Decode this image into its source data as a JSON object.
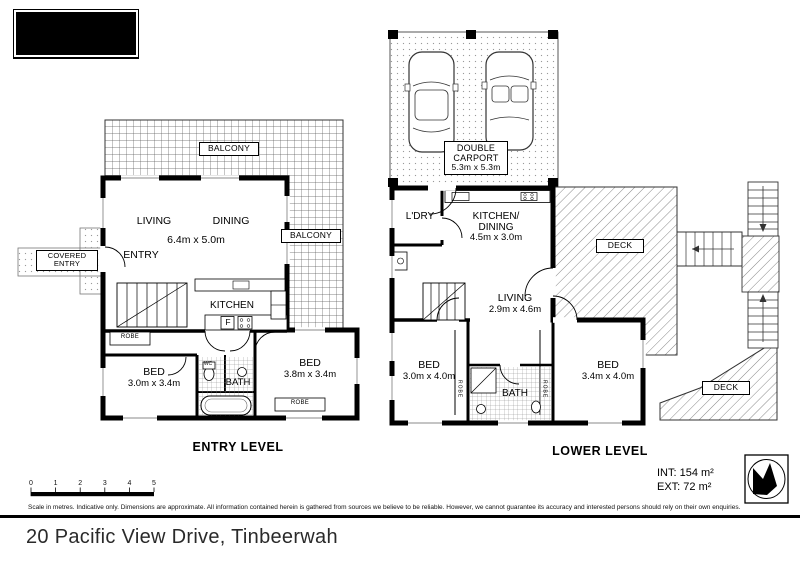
{
  "colors": {
    "ink": "#000000",
    "paper": "#ffffff",
    "hatch": "#6a6a6a"
  },
  "entry_level": {
    "title": "ENTRY LEVEL",
    "labels": {
      "balcony_top": "BALCONY",
      "balcony_right": "BALCONY",
      "living": "LIVING",
      "dining": "DINING",
      "living_dining_dims": "6.4m x 5.0m",
      "entry": "ENTRY",
      "covered_entry": "COVERED ENTRY",
      "kitchen": "KITCHEN",
      "fridge": "F",
      "robe_hall": "ROBE",
      "bed1": "BED",
      "bed1_dims": "3.0m x 3.4m",
      "wc": "WC",
      "bath": "BATH",
      "bed2": "BED",
      "bed2_dims": "3.8m x 3.4m",
      "robe_bed2": "ROBE"
    }
  },
  "lower_level": {
    "title": "LOWER LEVEL",
    "labels": {
      "carport_line1": "DOUBLE",
      "carport_line2": "CARPORT",
      "carport_dims": "5.3m x 5.3m",
      "laundry": "L'DRY",
      "kitchen_dining_line1": "KITCHEN/",
      "kitchen_dining_line2": "DINING",
      "kitchen_dining_dims": "4.5m x 3.0m",
      "deck_upper": "DECK",
      "living": "LIVING",
      "living_dims": "2.9m x 4.6m",
      "bed1": "BED",
      "bed1_dims": "3.0m x 4.0m",
      "robe_left": "ROBE",
      "bath": "BATH",
      "robe_right": "ROBE",
      "bed2": "BED",
      "bed2_dims": "3.4m x 4.0m",
      "deck_lower": "DECK"
    }
  },
  "footer": {
    "scale_ticks": [
      "0",
      "1",
      "2",
      "3",
      "4",
      "5"
    ],
    "disclaimer": "Scale in metres. Indicative only. Dimensions are approximate. All information contained herein is gathered from sources we believe to be reliable. However, we cannot guarantee its accuracy and interested persons should rely on their own enquiries.",
    "areas": {
      "internal": "INT: 154 m²",
      "external": "EXT: 72 m²"
    },
    "address": "20 Pacific View Drive, Tinbeerwah"
  }
}
